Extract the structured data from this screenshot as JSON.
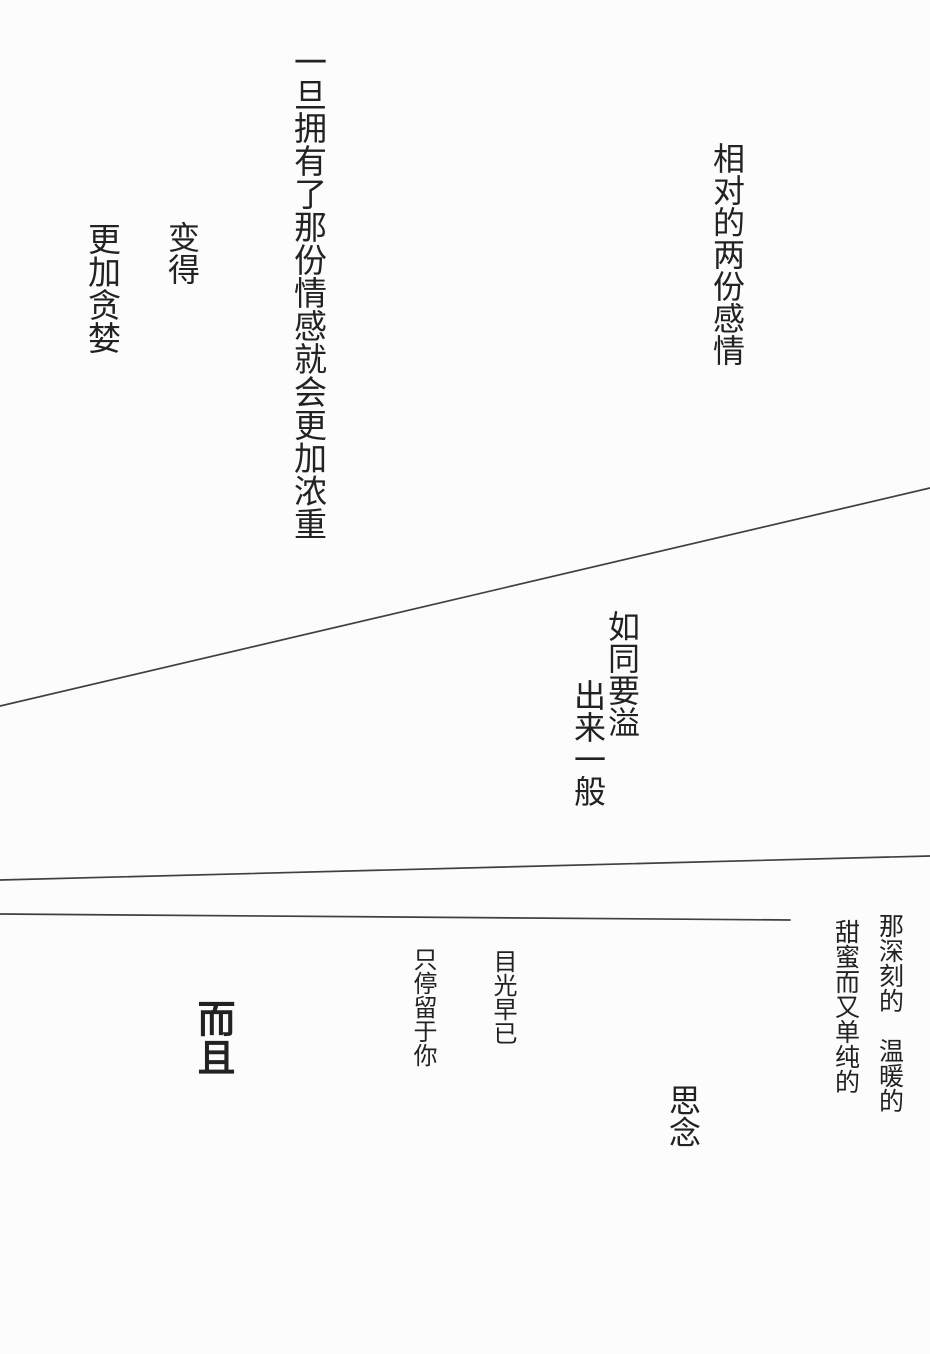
{
  "page": {
    "background": "#fcfcfc",
    "ink_color": "#222222",
    "line_color": "#404040"
  },
  "text_blocks": {
    "once_possessed": {
      "text": "一旦拥有了那份情感就会更加浓重"
    },
    "become": {
      "text": "变得"
    },
    "more_greedy": {
      "text": "更加贪婪"
    },
    "relative": {
      "text": "相对的两份感情"
    },
    "overflow_col1": {
      "text": "如同要溢"
    },
    "overflow_col2": {
      "text": "出来一般"
    },
    "deep_warm": {
      "text": "那深刻的　温暖的"
    },
    "sweet_pure": {
      "text": "甜蜜而又单纯的"
    },
    "gaze_already": {
      "text": "目光早已"
    },
    "linger_on_you": {
      "text": "只停留于你"
    },
    "moreover": {
      "text": "而且"
    },
    "longing": {
      "text": "思念"
    }
  },
  "divider_lines": [
    {
      "x1": 0,
      "y1": 706,
      "x2": 930,
      "y2": 488
    },
    {
      "x1": 0,
      "y1": 880,
      "x2": 930,
      "y2": 856
    },
    {
      "x1": 0,
      "y1": 914,
      "x2": 790,
      "y2": 920
    }
  ]
}
